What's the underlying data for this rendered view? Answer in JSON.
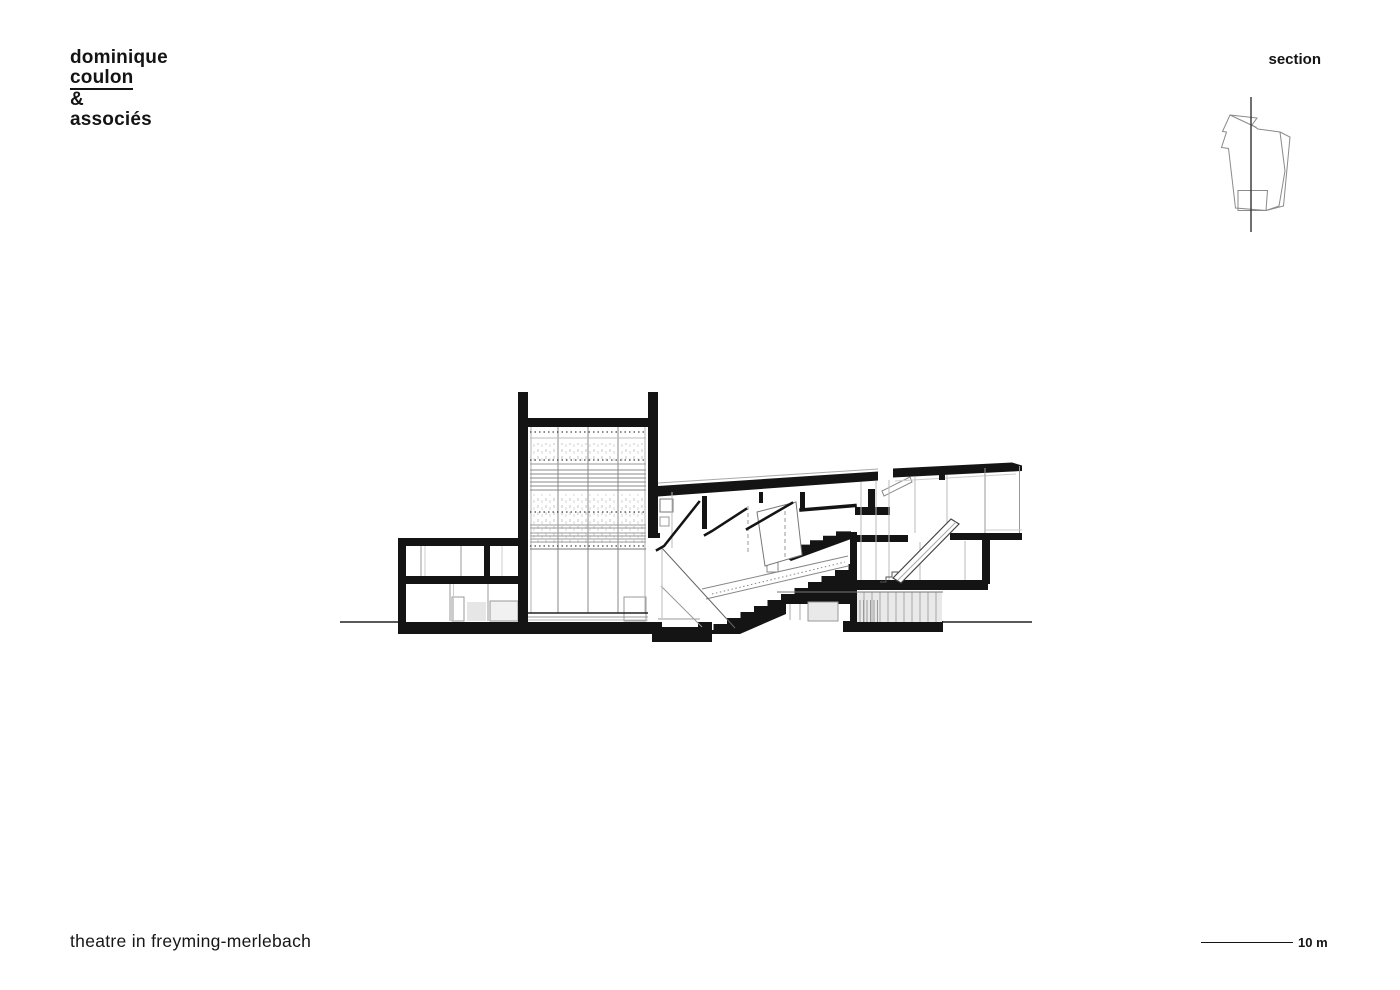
{
  "page": {
    "background": "#ffffff",
    "ink": "#141414"
  },
  "branding": {
    "name_line1": "dominique",
    "name_line2": "coulon",
    "name_line3": "&",
    "name_line4": "associés"
  },
  "header": {
    "view_label": "section"
  },
  "footer": {
    "project_title": "theatre in freyming-merlebach"
  },
  "scale_bar": {
    "label": "10 m"
  },
  "key_plan": {
    "description": "miniature building plan crossed by vertical section cut line"
  },
  "section_drawing": {
    "description": "cross section through the theatre: backstage annex at left, tall fly tower over the stage, raked auditorium seating with suspended acoustic reflectors, multi-level foyer with staircase, roof sloping up toward the glazed entrance facade at right",
    "colors": {
      "ink": "#141414",
      "medium_line": "#777777",
      "light_line": "#aaaaaa",
      "panel_fill": "#e8e8e8"
    }
  }
}
